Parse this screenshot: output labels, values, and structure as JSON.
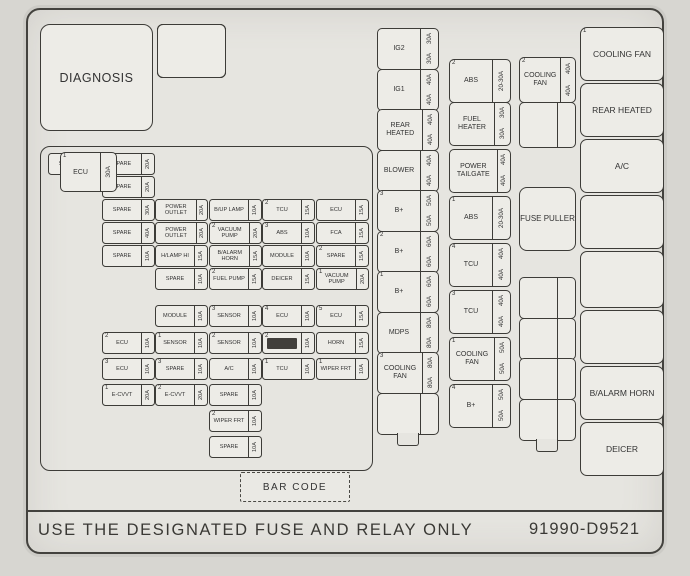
{
  "title_box": {
    "diagnosis": "DIAGNOSIS"
  },
  "relay_grid": {
    "cells": [
      {
        "label": "BLOWER"
      },
      {
        "label": "START"
      },
      {
        "label": "COOLING FAN",
        "sup": "2"
      },
      {
        "label": ""
      },
      {
        "label": "FUEL PUMP"
      },
      {
        "label": ""
      }
    ]
  },
  "left_grid": {
    "fuses": [
      {
        "r": 1,
        "c": 1,
        "label": "SPARE",
        "amp": "10A"
      },
      {
        "r": 1,
        "c": 2,
        "label": "SPARE",
        "amp": "20A"
      },
      {
        "r": 2,
        "c": 2,
        "label": "SPARE",
        "amp": "20A"
      },
      {
        "r": 3,
        "c": 2,
        "label": "SPARE",
        "amp": "30A"
      },
      {
        "r": 3,
        "c": 3,
        "label": "POWER OUTLET",
        "amp": "20A"
      },
      {
        "r": 3,
        "c": 4,
        "label": "B/UP LAMP",
        "amp": "10A"
      },
      {
        "r": 3,
        "c": 5,
        "label": "TCU",
        "amp": "15A",
        "sup": "2"
      },
      {
        "r": 3,
        "c": 6,
        "label": "ECU",
        "amp": "15A"
      },
      {
        "r": 4,
        "c": 2,
        "label": "SPARE",
        "amp": "40A"
      },
      {
        "r": 4,
        "c": 3,
        "label": "POWER OUTLET",
        "amp": "20A"
      },
      {
        "r": 4,
        "c": 4,
        "label": "VACUUM PUMP",
        "amp": "20A",
        "sup": "2"
      },
      {
        "r": 4,
        "c": 5,
        "label": "ABS",
        "amp": "10A",
        "sup": "3"
      },
      {
        "r": 4,
        "c": 6,
        "label": "FCA",
        "amp": "15A"
      },
      {
        "r": 5,
        "c": 2,
        "label": "SPARE",
        "amp": "10A"
      },
      {
        "r": 5,
        "c": 3,
        "label": "H/LAMP HI",
        "amp": "15A"
      },
      {
        "r": 5,
        "c": 4,
        "label": "B/ALARM HORN",
        "amp": "15A"
      },
      {
        "r": 5,
        "c": 5,
        "label": "MODULE",
        "amp": "10A"
      },
      {
        "r": 5,
        "c": 6,
        "label": "SPARE",
        "amp": "15A",
        "sup": "2"
      },
      {
        "r": 6,
        "c": 3,
        "label": "SPARE",
        "amp": "10A"
      },
      {
        "r": 6,
        "c": 4,
        "label": "FUEL PUMP",
        "amp": "15A",
        "sup": "2"
      },
      {
        "r": 6,
        "c": 5,
        "label": "DEICER",
        "amp": "15A"
      },
      {
        "r": 6,
        "c": 6,
        "label": "VACUUM PUMP",
        "amp": "20A",
        "sup": "1"
      },
      {
        "r": 7,
        "c": 3,
        "label": "MODULE",
        "amp": "10A"
      },
      {
        "r": 7,
        "c": 4,
        "label": "SENSOR",
        "amp": "10A",
        "sup": "3"
      },
      {
        "r": 7,
        "c": 5,
        "label": "ECU",
        "amp": "10A",
        "sup": "4"
      },
      {
        "r": 7,
        "c": 6,
        "label": "ECU",
        "amp": "15A",
        "sup": "5"
      },
      {
        "r": 8,
        "c": 2,
        "label": "ECU",
        "amp": "10A",
        "sup": "2"
      },
      {
        "r": 8,
        "c": 3,
        "label": "SENSOR",
        "amp": "10A",
        "sup": "1"
      },
      {
        "r": 8,
        "c": 4,
        "label": "SENSOR",
        "amp": "10A",
        "sup": "2"
      },
      {
        "r": 8,
        "c": 5,
        "label": "",
        "amp": "10A",
        "sup": "2",
        "smudge": true
      },
      {
        "r": 8,
        "c": 6,
        "label": "HORN",
        "amp": "15A"
      },
      {
        "r": 9,
        "c": 2,
        "label": "ECU",
        "amp": "10A",
        "sup": "3"
      },
      {
        "r": 9,
        "c": 3,
        "label": "SPARE",
        "amp": "10A",
        "sup": "3"
      },
      {
        "r": 9,
        "c": 4,
        "label": "A/C",
        "amp": "10A"
      },
      {
        "r": 9,
        "c": 5,
        "label": "TCU",
        "amp": "10A",
        "sup": "1"
      },
      {
        "r": 9,
        "c": 6,
        "label": "WIPER FRT",
        "amp": "10A",
        "sup": "1"
      },
      {
        "r": 10,
        "c": 2,
        "label": "E-CVVT",
        "amp": "20A",
        "sup": "1"
      },
      {
        "r": 10,
        "c": 3,
        "label": "E-CVVT",
        "amp": "20A",
        "sup": "2"
      },
      {
        "r": 10,
        "c": 4,
        "label": "SPARE",
        "amp": "10A"
      },
      {
        "r": 11,
        "c": 4,
        "label": "WIPER FRT",
        "amp": "10A",
        "sup": "2"
      },
      {
        "r": 12,
        "c": 4,
        "label": "SPARE",
        "amp": "10A"
      }
    ],
    "ecu_main": {
      "sup": "1",
      "label": "ECU",
      "amp": "30A"
    }
  },
  "column1": {
    "fuses": [
      {
        "label": "IG2",
        "amp": "30A"
      },
      {
        "label": "IG1",
        "amp": "40A"
      },
      {
        "label": "REAR HEATED",
        "amp": "40A"
      },
      {
        "label": "BLOWER",
        "amp": "40A"
      },
      {
        "label": "B+",
        "amp": "50A",
        "sup": "3"
      },
      {
        "label": "B+",
        "amp": "60A",
        "sup": "2"
      },
      {
        "label": "B+",
        "amp": "60A",
        "sup": "1"
      },
      {
        "label": "MDPS",
        "amp": "80A"
      },
      {
        "label": "COOLING FAN",
        "amp": "80A",
        "sup": "3"
      },
      {
        "label": "",
        "amp": ""
      }
    ]
  },
  "column2": {
    "fuses": [
      {
        "label": "ABS",
        "amp": "20-30A",
        "sup": "2"
      },
      {
        "label": "FUEL HEATER",
        "amp": "30A"
      },
      {
        "label": "POWER TAILGATE",
        "amp": "40A"
      },
      {
        "label": "ABS",
        "amp": "20-30A",
        "sup": "1"
      },
      {
        "label": "TCU",
        "amp": "40A",
        "sup": "4"
      },
      {
        "label": "TCU",
        "amp": "40A",
        "sup": "3"
      },
      {
        "label": "COOLING FAN",
        "amp": "50A",
        "sup": "1"
      },
      {
        "label": "B+",
        "amp": "50A",
        "sup": "4"
      }
    ]
  },
  "column3": {
    "fuses": [
      {
        "label": "COOLING FAN",
        "amp": "40A",
        "sup": "2"
      },
      {
        "label": "",
        "amp": ""
      }
    ],
    "puller_label": "FUSE PULLER",
    "empty_block": [
      {
        "label": "",
        "amp": ""
      },
      {
        "label": "",
        "amp": ""
      },
      {
        "label": "",
        "amp": ""
      },
      {
        "label": "",
        "amp": ""
      }
    ]
  },
  "right_column": {
    "relays": [
      {
        "label": "COOLING FAN",
        "sup": "1"
      },
      {
        "label": "REAR HEATED"
      },
      {
        "label": "A/C"
      },
      {
        "label": ""
      },
      {
        "label": ""
      },
      {
        "label": ""
      },
      {
        "label": "B/ALARM HORN"
      },
      {
        "label": "DEICER"
      }
    ]
  },
  "bottom": {
    "barcode_label": "BAR CODE",
    "warning": "USE THE DESIGNATED FUSE AND RELAY ONLY",
    "part_number": "91990-D9521"
  }
}
